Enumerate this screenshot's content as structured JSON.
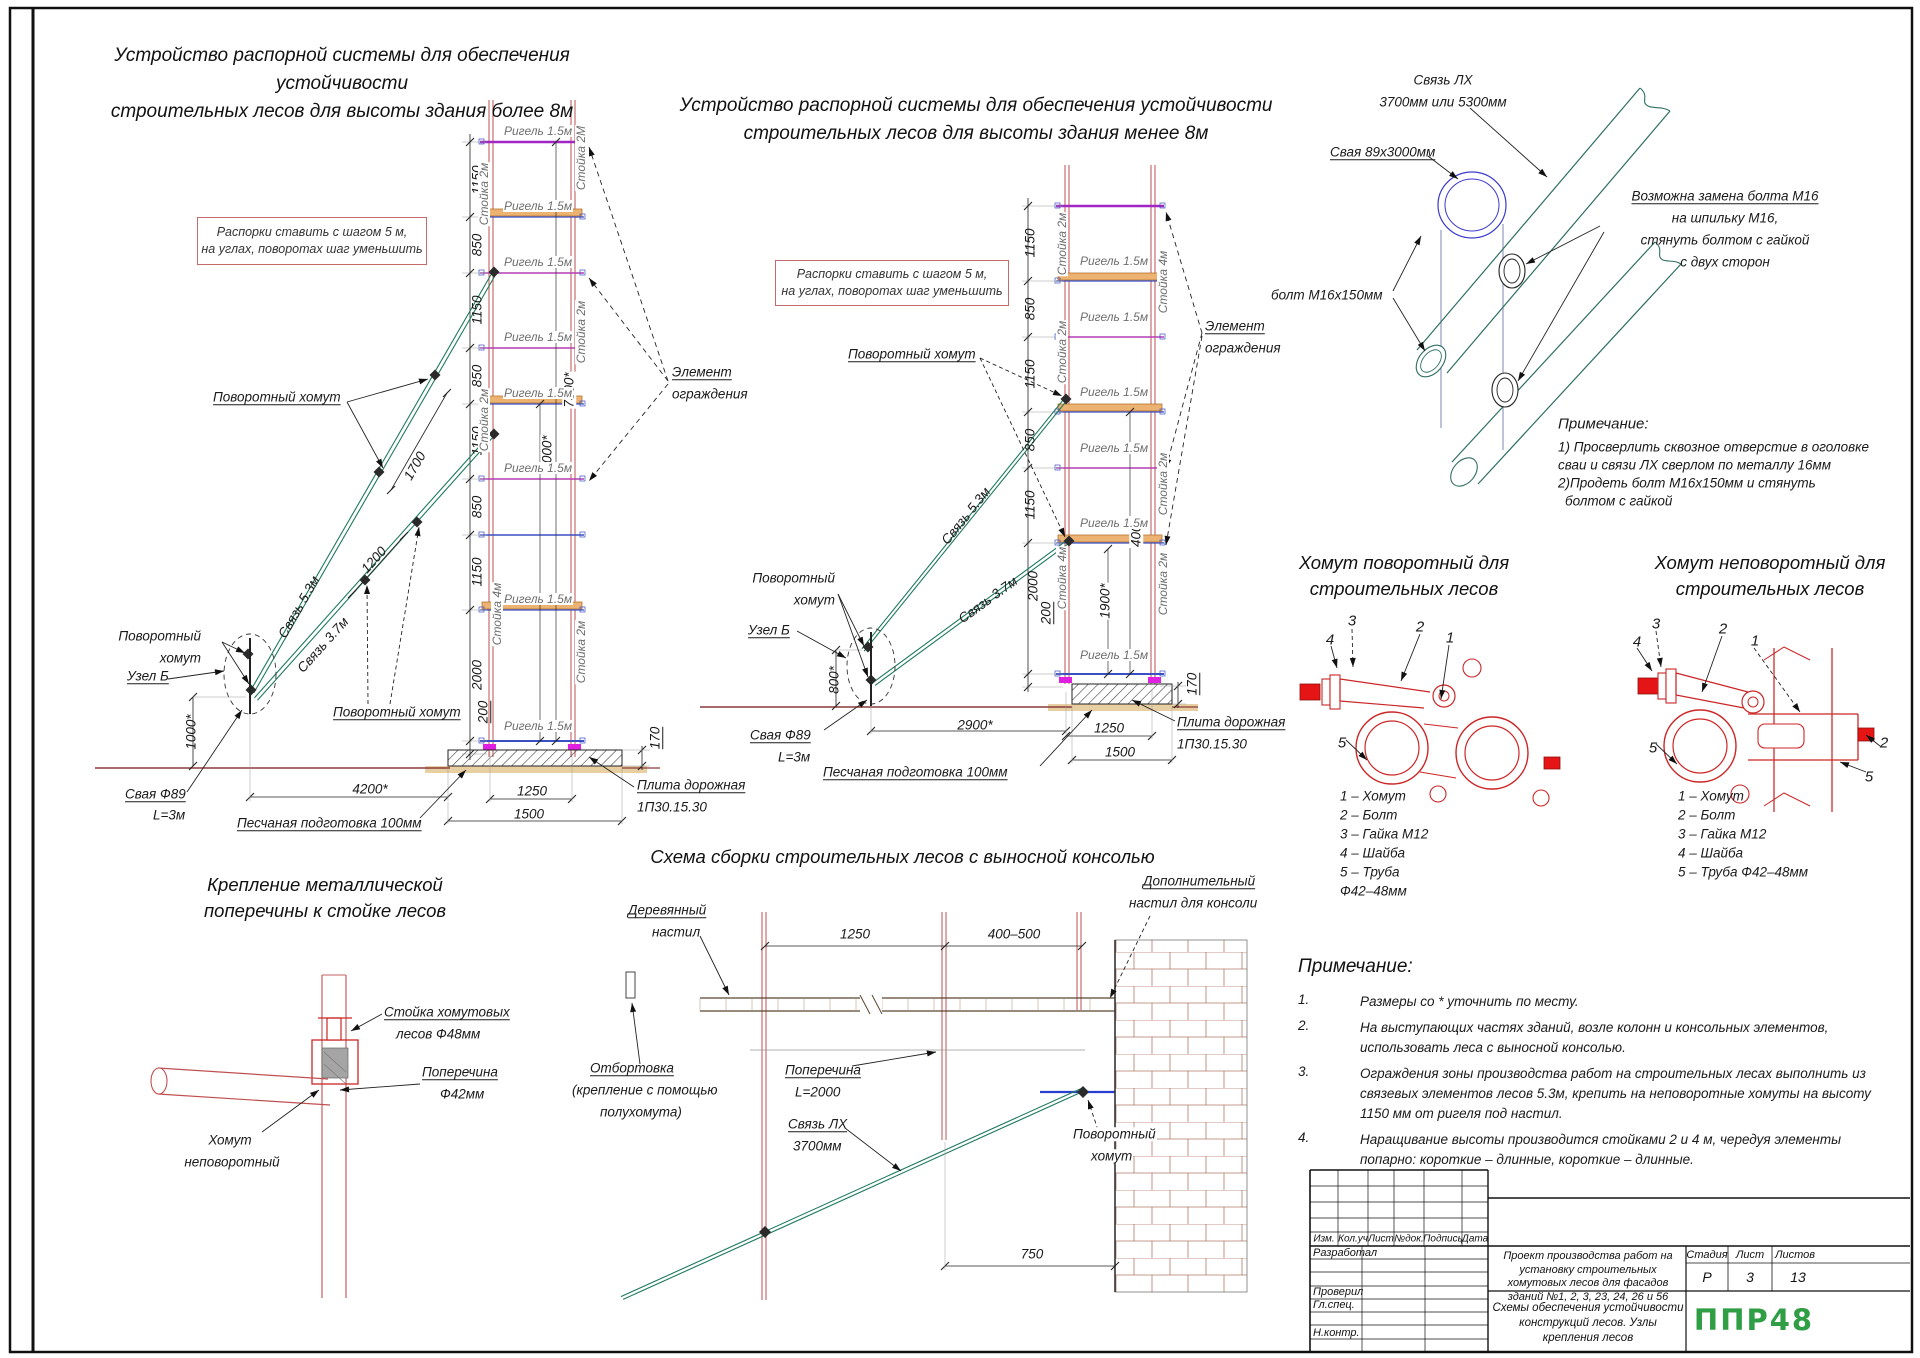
{
  "left_scheme": {
    "title": "Устройство распорной системы для обеспечения устойчивости\nстроительных лесов для высоты здания более 8м",
    "note": "Распорки ставить с шагом 5 м,\nна углах, поворотах шаг уменьшить"
  },
  "mid_scheme": {
    "title": "Устройство распорной системы для обеспечения устойчивости\nстроительных лесов для высоты здания менее 8м",
    "note": "Распорки ставить с шагом 5 м,\nна углах, поворотах шаг уменьшить"
  },
  "clamp_sections": {
    "left_title": "Хомут поворотный для\nстроительных лесов",
    "right_title": "Хомут неповоротный для\nстроительных лесов",
    "left_parts": [
      "1 – Хомут",
      "2 – Болт",
      "3 – Гайка М12",
      "4 – Шайба",
      "5 – Труба",
      "Ф42–48мм"
    ],
    "right_parts": [
      "1 – Хомут",
      "2 – Болт",
      "3 – Гайка М12",
      "4 – Шайба",
      "5 – Труба Ф42–48мм"
    ]
  },
  "bottom_left": {
    "title": "Крепление металлической\nпоперечины к стойке лесов"
  },
  "console_scheme": {
    "title": "Схема сборки строительных лесов с выносной консолью"
  },
  "notes": {
    "heading": "Примечание:",
    "items": [
      "Размеры со * уточнить по месту.",
      "На выступающих частях зданий, возле колонн и консольных элементов,\nиспользовать леса с выносной консолью.",
      "Ограждения зоны производства работ на строительных лесах выполнить из\nсвязевых элементов лесов 5.3м, крепить на неповоротные хомуты на высоту\n1150 мм от ригеля под настил.",
      "Наращивание высоты производится стойками 2 и 4 м, чередуя элементы\nпопарно: короткие – длинные, короткие – длинные."
    ]
  },
  "title_block": {
    "rev_headers": [
      "Изм.",
      "Кол.уч",
      "Лист",
      "№док.",
      "Подпись",
      "Дата"
    ],
    "staff": [
      "Разработал",
      "Проверил",
      "Гл.спец.",
      "Н.контр."
    ],
    "project": "Проект производства работ на установку строительных хомутовых лесов для фасадов зданий №1, 2, 3, 23, 24, 26 и 56",
    "stage_label": "Стадия",
    "sheet_label": "Лист",
    "sheets_label": "Листов",
    "stage": "Р",
    "sheet": "3",
    "sheets": "13",
    "doc_title": "Схемы обеспечения устойчивости конструкций лесов. Узлы крепления лесов",
    "logo": "ППР48",
    "accent_green": "#2f9e44"
  },
  "labels": [
    {
      "n": "l-dim-1150-1",
      "t": "1150",
      "x": 477,
      "y": 180,
      "r": -90
    },
    {
      "n": "l-dim-850-1",
      "t": "850",
      "x": 477,
      "y": 245,
      "r": -90
    },
    {
      "n": "l-dim-1150-2",
      "t": "1150",
      "x": 477,
      "y": 310,
      "r": -90
    },
    {
      "n": "l-dim-850-2",
      "t": "850",
      "x": 477,
      "y": 376,
      "r": -90
    },
    {
      "n": "l-dim-1150-3",
      "t": "1150",
      "x": 477,
      "y": 441,
      "r": -90
    },
    {
      "n": "l-dim-850-3",
      "t": "850",
      "x": 477,
      "y": 507,
      "r": -90
    },
    {
      "n": "l-dim-1150-4",
      "t": "1150",
      "x": 477,
      "y": 572,
      "r": -90
    },
    {
      "n": "l-dim-2000",
      "t": "2000",
      "x": 477,
      "y": 675,
      "r": -90
    },
    {
      "n": "l-dim-200",
      "t": "200",
      "x": 483,
      "y": 712,
      "r": -90,
      "u": 1
    },
    {
      "n": "l-dim-7500",
      "t": "7500*",
      "x": 569,
      "y": 390,
      "r": -90,
      "bg": 1
    },
    {
      "n": "l-dim-4000",
      "t": "4000*",
      "x": 547,
      "y": 453,
      "r": -90,
      "bg": 1
    },
    {
      "n": "l-dim-1700",
      "t": "1700",
      "x": 415,
      "y": 466,
      "r": -60
    },
    {
      "n": "l-dim-1200",
      "t": "1200",
      "x": 374,
      "y": 560,
      "r": -48
    },
    {
      "n": "l-dim-1000",
      "t": "1000*",
      "x": 191,
      "y": 732,
      "r": -90
    },
    {
      "n": "l-callout-povorotny-1",
      "t": "Поворотный хомут",
      "x": 213,
      "y": 397,
      "u": 1
    },
    {
      "n": "l-svyaz-53",
      "t": "Связь 5.3м",
      "x": 299,
      "y": 607,
      "r": -60
    },
    {
      "n": "l-svyaz-37",
      "t": "Связь 3.7м",
      "x": 323,
      "y": 645,
      "r": -48
    },
    {
      "n": "l-callout-povorotny-2a",
      "t": "Поворотный",
      "x": 201,
      "y": 636,
      "a": "r"
    },
    {
      "n": "l-callout-povorotny-2b",
      "t": "хомут",
      "x": 201,
      "y": 658,
      "a": "r"
    },
    {
      "n": "l-callout-uzel-b",
      "t": "Узел Б",
      "x": 127,
      "y": 676,
      "u": 1
    },
    {
      "n": "l-callout-povorotny-3",
      "t": "Поворотный хомут",
      "x": 333,
      "y": 712,
      "u": 1
    },
    {
      "n": "l-callout-svaya-a",
      "t": "Свая Ф89",
      "x": 125,
      "y": 794,
      "u": 1
    },
    {
      "n": "l-callout-svaya-b",
      "t": "L=3м",
      "x": 153,
      "y": 815
    },
    {
      "n": "l-dim-4200",
      "t": "4200*",
      "x": 370,
      "y": 789,
      "a": "c"
    },
    {
      "n": "l-callout-peschanaya",
      "t": "Песчаная подготовка 100мм",
      "x": 237,
      "y": 823,
      "u": 1
    },
    {
      "n": "l-dim-1250",
      "t": "1250",
      "x": 532,
      "y": 791,
      "a": "c"
    },
    {
      "n": "l-dim-1500",
      "t": "1500",
      "x": 529,
      "y": 814,
      "a": "c"
    },
    {
      "n": "l-callout-plita-a",
      "t": "Плита дорожная",
      "x": 637,
      "y": 785,
      "u": 1
    },
    {
      "n": "l-callout-plita-b",
      "t": "1П30.15.30",
      "x": 637,
      "y": 807
    },
    {
      "n": "l-dim-170",
      "t": "170",
      "x": 655,
      "y": 738,
      "r": -90,
      "u": 1
    },
    {
      "n": "l-callout-element-a",
      "t": "Элемент",
      "x": 672,
      "y": 372,
      "u": 1
    },
    {
      "n": "l-callout-element-b",
      "t": "ограждения",
      "x": 672,
      "y": 394
    },
    {
      "n": "l-rigel-1",
      "t": "Ригель 1.5м",
      "x": 503,
      "y": 131,
      "c": "g",
      "bg": 1
    },
    {
      "n": "l-rigel-2",
      "t": "Ригель 1.5м",
      "x": 503,
      "y": 206,
      "c": "g",
      "bg": 1
    },
    {
      "n": "l-rigel-3",
      "t": "Ригель 1.5м",
      "x": 503,
      "y": 262,
      "c": "g",
      "bg": 1
    },
    {
      "n": "l-rigel-4",
      "t": "Ригель 1.5м",
      "x": 503,
      "y": 337,
      "c": "g",
      "bg": 1
    },
    {
      "n": "l-rigel-5",
      "t": "Ригель 1.5м",
      "x": 503,
      "y": 393,
      "c": "g",
      "bg": 1
    },
    {
      "n": "l-rigel-6",
      "t": "Ригель 1.5м",
      "x": 503,
      "y": 468,
      "c": "g",
      "bg": 1
    },
    {
      "n": "l-rigel-7",
      "t": "Ригель 1.5м",
      "x": 503,
      "y": 599,
      "c": "g",
      "bg": 1
    },
    {
      "n": "l-rigel-8",
      "t": "Ригель 1.5м",
      "x": 503,
      "y": 726,
      "c": "g",
      "bg": 1
    },
    {
      "n": "l-stoyka-r1",
      "t": "Стойка 2М",
      "x": 581,
      "y": 158,
      "r": -90,
      "c": "g",
      "bg": 1
    },
    {
      "n": "l-stoyka-r2",
      "t": "Стойка 2м",
      "x": 581,
      "y": 332,
      "r": -90,
      "c": "g",
      "bg": 1
    },
    {
      "n": "l-stoyka-r3",
      "t": "Стойка 2м",
      "x": 581,
      "y": 652,
      "r": -90,
      "c": "g",
      "bg": 1
    },
    {
      "n": "l-stoyka-l1",
      "t": "Стойка 2м",
      "x": 484,
      "y": 194,
      "r": -90,
      "c": "g",
      "bg": 1
    },
    {
      "n": "l-stoyka-l2",
      "t": "Стойка 2м",
      "x": 484,
      "y": 420,
      "r": -90,
      "c": "g",
      "bg": 1
    },
    {
      "n": "l-stoyka-l3",
      "t": "Стойка 4м",
      "x": 497,
      "y": 614,
      "r": -90,
      "c": "g",
      "bg": 1
    },
    {
      "n": "m-dim-1150-1",
      "t": "1150",
      "x": 1030,
      "y": 243,
      "r": -90
    },
    {
      "n": "m-dim-850-1",
      "t": "850",
      "x": 1030,
      "y": 309,
      "r": -90
    },
    {
      "n": "m-dim-1150-2",
      "t": "1150",
      "x": 1030,
      "y": 374,
      "r": -90
    },
    {
      "n": "m-dim-850-2",
      "t": "850",
      "x": 1030,
      "y": 440,
      "r": -90
    },
    {
      "n": "m-dim-1150-3",
      "t": "1150",
      "x": 1030,
      "y": 505,
      "r": -90
    },
    {
      "n": "m-dim-2000",
      "t": "2000",
      "x": 1033,
      "y": 586,
      "r": -90
    },
    {
      "n": "m-dim-200",
      "t": "200",
      "x": 1046,
      "y": 613,
      "r": -90,
      "u": 1
    },
    {
      "n": "m-dim-4000",
      "t": "4000",
      "x": 1136,
      "y": 532,
      "r": -90,
      "bg": 1
    },
    {
      "n": "m-dim-1900",
      "t": "1900*",
      "x": 1105,
      "y": 601,
      "r": -90,
      "bg": 1
    },
    {
      "n": "m-dim-170",
      "t": "170",
      "x": 1192,
      "y": 684,
      "r": -90,
      "u": 1
    },
    {
      "n": "m-dim-2900",
      "t": "2900*",
      "x": 975,
      "y": 725,
      "a": "c"
    },
    {
      "n": "m-dim-800",
      "t": "800*",
      "x": 834,
      "y": 680,
      "r": -90
    },
    {
      "n": "m-dim-1250",
      "t": "1250",
      "x": 1109,
      "y": 728,
      "a": "c"
    },
    {
      "n": "m-dim-1500",
      "t": "1500",
      "x": 1120,
      "y": 752,
      "a": "c"
    },
    {
      "n": "m-callout-povorotny-1",
      "t": "Поворотный хомут",
      "x": 848,
      "y": 354,
      "u": 1
    },
    {
      "n": "m-callout-povorotny-2a",
      "t": "Поворотный",
      "x": 835,
      "y": 578,
      "a": "r"
    },
    {
      "n": "m-callout-povorotny-2b",
      "t": "хомут",
      "x": 835,
      "y": 600,
      "a": "r"
    },
    {
      "n": "m-callout-uzel-b",
      "t": "Узел Б",
      "x": 748,
      "y": 630,
      "u": 1
    },
    {
      "n": "m-callout-svaya-a",
      "t": "Свая Ф89",
      "x": 750,
      "y": 735,
      "u": 1
    },
    {
      "n": "m-callout-svaya-b",
      "t": "L=3м",
      "x": 778,
      "y": 757
    },
    {
      "n": "m-callout-peschanaya",
      "t": "Песчаная подготовка 100мм",
      "x": 823,
      "y": 772,
      "u": 1
    },
    {
      "n": "m-callout-plita-a",
      "t": "Плита дорожная",
      "x": 1177,
      "y": 722,
      "u": 1
    },
    {
      "n": "m-callout-plita-b",
      "t": "1П30.15.30",
      "x": 1177,
      "y": 744
    },
    {
      "n": "m-callout-element-a",
      "t": "Элемент",
      "x": 1205,
      "y": 326,
      "u": 1
    },
    {
      "n": "m-callout-element-b",
      "t": "ограждения",
      "x": 1205,
      "y": 348
    },
    {
      "n": "m-svyaz-53",
      "t": "Связь 5.3м",
      "x": 966,
      "y": 516,
      "r": -51
    },
    {
      "n": "m-svyaz-37",
      "t": "Связь 3.7м",
      "x": 988,
      "y": 600,
      "r": -36
    },
    {
      "n": "m-rigel-1",
      "t": "Ригель 1.5м",
      "x": 1079,
      "y": 261,
      "c": "g",
      "bg": 1
    },
    {
      "n": "m-rigel-2",
      "t": "Ригель 1.5м",
      "x": 1079,
      "y": 317,
      "c": "g",
      "bg": 1
    },
    {
      "n": "m-rigel-3",
      "t": "Ригель 1.5м",
      "x": 1079,
      "y": 392,
      "c": "g",
      "bg": 1
    },
    {
      "n": "m-rigel-4",
      "t": "Ригель 1.5м",
      "x": 1079,
      "y": 448,
      "c": "g",
      "bg": 1
    },
    {
      "n": "m-rigel-5",
      "t": "Ригель 1.5м",
      "x": 1079,
      "y": 523,
      "c": "g",
      "bg": 1
    },
    {
      "n": "m-rigel-6",
      "t": "Ригель 1.5м",
      "x": 1079,
      "y": 655,
      "c": "g",
      "bg": 1
    },
    {
      "n": "m-stoyka-l1",
      "t": "Стойка 2м",
      "x": 1062,
      "y": 244,
      "r": -90,
      "c": "g",
      "bg": 1
    },
    {
      "n": "m-stoyka-l2",
      "t": "Стойка 2м",
      "x": 1062,
      "y": 352,
      "r": -90,
      "c": "g",
      "bg": 1
    },
    {
      "n": "m-stoyka-l3",
      "t": "Стойка 4м",
      "x": 1062,
      "y": 578,
      "r": -90,
      "c": "g",
      "bg": 1
    },
    {
      "n": "m-stoyka-r1",
      "t": "Стойка 4м",
      "x": 1163,
      "y": 282,
      "r": -90,
      "c": "g",
      "bg": 1
    },
    {
      "n": "m-stoyka-r2",
      "t": "Стойка 2м",
      "x": 1163,
      "y": 484,
      "r": -90,
      "c": "g",
      "bg": 1
    },
    {
      "n": "m-stoyka-r3",
      "t": "Стойка 2м",
      "x": 1163,
      "y": 584,
      "r": -90,
      "c": "g",
      "bg": 1
    },
    {
      "n": "p-svyaz-lh-a",
      "t": "Связь ЛХ",
      "x": 1443,
      "y": 80,
      "a": "c"
    },
    {
      "n": "p-svyaz-lh-b",
      "t": "3700мм или 5300мм",
      "x": 1443,
      "y": 102,
      "a": "c"
    },
    {
      "n": "p-svaya",
      "t": "Свая 89х3000мм",
      "x": 1330,
      "y": 152,
      "u": 1
    },
    {
      "n": "p-bolt",
      "t": "болт М16х150мм",
      "x": 1271,
      "y": 295
    },
    {
      "n": "p-zamena-1",
      "t": "Возможна замена болта М16",
      "x": 1725,
      "y": 196,
      "a": "c",
      "u": 1
    },
    {
      "n": "p-zamena-2",
      "t": "на шпильку М16,",
      "x": 1725,
      "y": 218,
      "a": "c"
    },
    {
      "n": "p-zamena-3",
      "t": "стянуть болтом с гайкой",
      "x": 1725,
      "y": 240,
      "a": "c"
    },
    {
      "n": "p-zamena-4",
      "t": "с двух сторон",
      "x": 1725,
      "y": 262,
      "a": "c"
    },
    {
      "n": "p-note-head",
      "t": "Примечание:",
      "x": 1558,
      "y": 424,
      "s": 15
    },
    {
      "n": "p-note-1",
      "t": "1) Просверлить сквозное отверстие в оголовке",
      "x": 1558,
      "y": 447
    },
    {
      "n": "p-note-2",
      "t": "сваи и связи ЛХ сверлом по металлу 16мм",
      "x": 1558,
      "y": 465
    },
    {
      "n": "p-note-3",
      "t": "2)Продеть болт М16х150мм и стянуть",
      "x": 1558,
      "y": 483
    },
    {
      "n": "p-note-4",
      "t": "болтом с гайкой",
      "x": 1565,
      "y": 501
    },
    {
      "n": "c-left-4",
      "t": "4",
      "x": 1330,
      "y": 640,
      "a": "c",
      "s": 15
    },
    {
      "n": "c-left-3",
      "t": "3",
      "x": 1352,
      "y": 621,
      "a": "c",
      "s": 15
    },
    {
      "n": "c-left-2",
      "t": "2",
      "x": 1420,
      "y": 627,
      "a": "c",
      "s": 15
    },
    {
      "n": "c-left-1",
      "t": "1",
      "x": 1450,
      "y": 638,
      "a": "c",
      "s": 15
    },
    {
      "n": "c-left-5",
      "t": "5",
      "x": 1342,
      "y": 743,
      "a": "c",
      "s": 15
    },
    {
      "n": "c-right-4",
      "t": "4",
      "x": 1637,
      "y": 642,
      "a": "c",
      "s": 15
    },
    {
      "n": "c-right-3",
      "t": "3",
      "x": 1656,
      "y": 624,
      "a": "c",
      "s": 15
    },
    {
      "n": "c-right-2",
      "t": "2",
      "x": 1723,
      "y": 629,
      "a": "c",
      "s": 15
    },
    {
      "n": "c-right-1",
      "t": "1",
      "x": 1755,
      "y": 641,
      "a": "c",
      "s": 15
    },
    {
      "n": "c-right-5",
      "t": "5",
      "x": 1653,
      "y": 748,
      "a": "c",
      "s": 15
    },
    {
      "n": "c-right-2b",
      "t": "2",
      "x": 1884,
      "y": 743,
      "a": "c",
      "s": 15
    },
    {
      "n": "c-right-5b",
      "t": "5",
      "x": 1869,
      "y": 777,
      "a": "c",
      "s": 15
    },
    {
      "n": "bl-stoyka-a",
      "t": "Стойка хомутовых",
      "x": 384,
      "y": 1012,
      "u": 1
    },
    {
      "n": "bl-stoyka-b",
      "t": "лесов Ф48мм",
      "x": 396,
      "y": 1034
    },
    {
      "n": "bl-poperechina-a",
      "t": "Поперечина",
      "x": 422,
      "y": 1072,
      "u": 1
    },
    {
      "n": "bl-poperechina-b",
      "t": "Ф42мм",
      "x": 440,
      "y": 1094
    },
    {
      "n": "bl-homut-a",
      "t": "Хомут",
      "x": 230,
      "y": 1140,
      "a": "c"
    },
    {
      "n": "bl-homut-b",
      "t": "неповоротный",
      "x": 232,
      "y": 1162,
      "a": "c"
    },
    {
      "n": "cs-nastil-a",
      "t": "Деревянный",
      "x": 628,
      "y": 910,
      "u": 1
    },
    {
      "n": "cs-nastil-b",
      "t": "настил",
      "x": 652,
      "y": 932
    },
    {
      "n": "cs-dim-1250",
      "t": "1250",
      "x": 855,
      "y": 934,
      "a": "c"
    },
    {
      "n": "cs-dim-400500",
      "t": "400–500",
      "x": 1014,
      "y": 934,
      "a": "c"
    },
    {
      "n": "cs-dop-a",
      "t": "Дополнительный",
      "x": 1142,
      "y": 881,
      "u": 1,
      "bg": 1
    },
    {
      "n": "cs-dop-b",
      "t": "настил для консоли",
      "x": 1128,
      "y": 903,
      "bg": 1
    },
    {
      "n": "cs-otbortovka-a",
      "t": "Отбортовка",
      "x": 590,
      "y": 1068,
      "u": 1
    },
    {
      "n": "cs-otbortovka-b",
      "t": "(крепление с помощью",
      "x": 572,
      "y": 1090
    },
    {
      "n": "cs-otbortovka-c",
      "t": "полухомута)",
      "x": 600,
      "y": 1112
    },
    {
      "n": "cs-poperechina-a",
      "t": "Поперечина",
      "x": 785,
      "y": 1070,
      "u": 1
    },
    {
      "n": "cs-poperechina-b",
      "t": "L=2000",
      "x": 795,
      "y": 1092
    },
    {
      "n": "cs-svyaz-a",
      "t": "Связь ЛХ",
      "x": 788,
      "y": 1124,
      "u": 1
    },
    {
      "n": "cs-svyaz-b",
      "t": "3700мм",
      "x": 793,
      "y": 1146
    },
    {
      "n": "cs-povorotny-a",
      "t": "Поворотный",
      "x": 1072,
      "y": 1134,
      "bg": 1
    },
    {
      "n": "cs-povorotny-b",
      "t": "хомут",
      "x": 1090,
      "y": 1156,
      "bg": 1
    },
    {
      "n": "cs-dim-750",
      "t": "750",
      "x": 1032,
      "y": 1254,
      "a": "c"
    }
  ]
}
